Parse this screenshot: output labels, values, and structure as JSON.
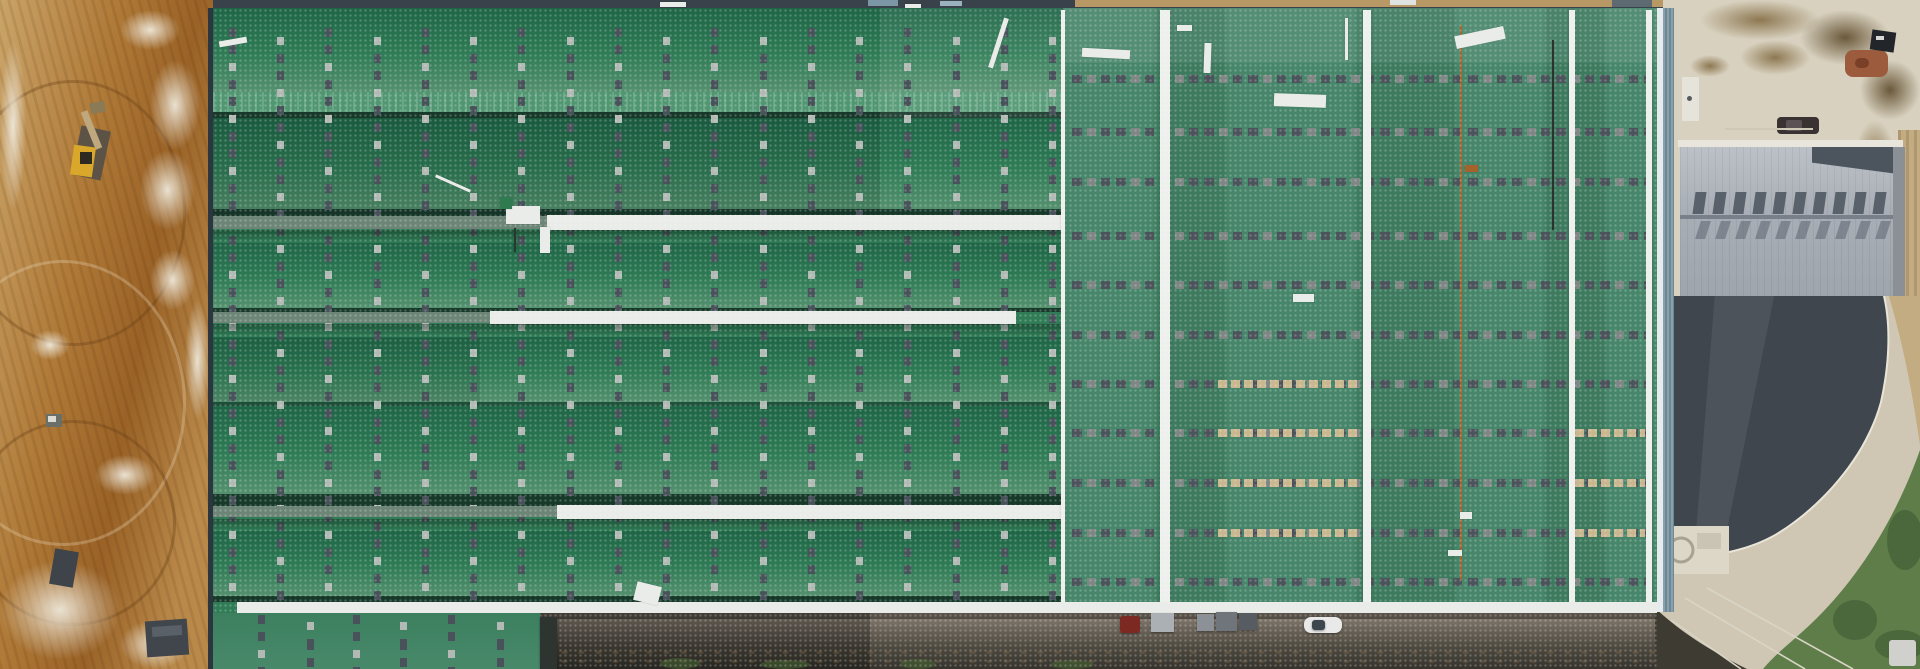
{
  "meta": {
    "scene_type": "aerial-drone-view-industrial-warehouse-roofs-construction-site",
    "width": 1920,
    "height": 669
  },
  "palette": {
    "dirt1": "#caa468",
    "dirt2": "#b07a38",
    "dirt3": "#9a6226",
    "dirt2b": "#b9894a",
    "g-dark": "#1e6546",
    "g-mid": "#2f7c56",
    "g-light": "#55916f",
    "g-ridge": "#4f9671",
    "g-right": "#47866a",
    "g-right-d": "#3d7a5e",
    "seam": "#17392a",
    "walk-white": "#e9ece9",
    "walk-gray": "#6c8576",
    "col-dark": "#49525a",
    "col-light": "#b3bab6",
    "row-dark": "#4b535b",
    "row-mid": "#7e8784",
    "row-beige": "#c9b78f",
    "ridge-white": "#edf0ed",
    "rust": "#a5622a",
    "edge-dark": "#2c363e",
    "edge-blue": "#87a0ad",
    "top-dark": "#39424b",
    "top-tan": "#c7a368",
    "apron": "#d8d1bf",
    "dirttrack": "#c3ab82",
    "groof1": "#bcc1c7",
    "groof2": "#9fa5ad",
    "gvent": "#59616b",
    "gridge": "#798089",
    "gtrap": "#4c545e",
    "parapet": "#e8e5dc",
    "gwall": "#8b9097",
    "slate": "#3f464e",
    "road": "#cfc7b3",
    "roadedge": "#e9e5d8",
    "veg": "#5e7d49",
    "vegd": "#46613a",
    "ground1": "#6e665c",
    "ground2": "#35332c"
  },
  "scene": {
    "green_building": {
      "left_columns_x": [
        229,
        277,
        325,
        374,
        422,
        470,
        518,
        567,
        615,
        663,
        711,
        760,
        808,
        856,
        904,
        953,
        1001,
        1049
      ],
      "extension_columns_x": [
        258,
        307,
        353,
        400,
        448,
        497
      ],
      "right_rows_y": [
        75,
        128,
        178,
        232,
        281,
        331,
        380,
        429,
        479,
        529,
        578
      ],
      "beige_rows": [
        {
          "x": 1218,
          "y": 380,
          "w": 140
        },
        {
          "x": 1218,
          "y": 429,
          "w": 140
        },
        {
          "x": 1218,
          "y": 479,
          "w": 140
        },
        {
          "x": 1218,
          "y": 529,
          "w": 140
        },
        {
          "x": 1575,
          "y": 429,
          "w": 70
        },
        {
          "x": 1575,
          "y": 479,
          "w": 70
        },
        {
          "x": 1575,
          "y": 529,
          "w": 70
        }
      ],
      "ridge_lines": [
        {
          "x": 1061,
          "w": 4
        },
        {
          "x": 1160,
          "w": 10
        },
        {
          "x": 1363,
          "w": 8
        },
        {
          "x": 1569,
          "w": 6
        },
        {
          "x": 1646,
          "w": 6
        }
      ],
      "panel_lines": [
        {
          "x": 1460,
          "y": 25,
          "w": 2,
          "h": 555,
          "color": "#a5622a",
          "name": "rust-seam-line"
        },
        {
          "x": 1552,
          "y": 40,
          "w": 2,
          "h": 190,
          "color": "#2a332e",
          "name": "dark-seam-line"
        }
      ],
      "roof_debris": [
        {
          "x": 219,
          "y": 39,
          "w": 28,
          "h": 6,
          "rot": -10
        },
        {
          "x": 660,
          "y": 2,
          "w": 26,
          "h": 5
        },
        {
          "x": 905,
          "y": 4,
          "w": 16,
          "h": 4
        },
        {
          "x": 996,
          "y": 17,
          "w": 5,
          "h": 52,
          "rot": 18
        },
        {
          "x": 1082,
          "y": 49,
          "w": 48,
          "h": 9,
          "rot": 3
        },
        {
          "x": 1177,
          "y": 25,
          "w": 15,
          "h": 6
        },
        {
          "x": 1204,
          "y": 43,
          "w": 7,
          "h": 30,
          "rot": 2
        },
        {
          "x": 1274,
          "y": 94,
          "w": 52,
          "h": 13,
          "rot": 2
        },
        {
          "x": 1293,
          "y": 294,
          "w": 21,
          "h": 8
        },
        {
          "x": 1455,
          "y": 31,
          "w": 50,
          "h": 13,
          "rot": -12
        },
        {
          "x": 1345,
          "y": 18,
          "w": 3,
          "h": 42
        },
        {
          "x": 635,
          "y": 584,
          "w": 25,
          "h": 19,
          "rot": 14
        },
        {
          "x": 434,
          "y": 182,
          "w": 38,
          "h": 3,
          "rot": 24
        },
        {
          "x": 1465,
          "y": 165,
          "w": 13,
          "h": 7,
          "color": "#a5622a",
          "name": "rust-patch"
        },
        {
          "x": 506,
          "y": 206,
          "w": 34,
          "h": 18,
          "name": "rooftop-equipment"
        },
        {
          "x": 540,
          "y": 227,
          "w": 10,
          "h": 26,
          "name": "rooftop-equipment"
        },
        {
          "x": 514,
          "y": 228,
          "w": 2,
          "h": 24,
          "color": "#2b3633",
          "name": "equipment-cable"
        },
        {
          "x": 500,
          "y": 197,
          "w": 12,
          "h": 12,
          "color": "#2f7a4e",
          "name": "rooftop-equipment"
        },
        {
          "x": 1460,
          "y": 512,
          "w": 12,
          "h": 7
        },
        {
          "x": 1448,
          "y": 550,
          "w": 14,
          "h": 6
        }
      ],
      "top_marks": [
        {
          "x": 868,
          "y": 0,
          "w": 30,
          "h": 6,
          "color": "#7b97a6"
        },
        {
          "x": 940,
          "y": 1,
          "w": 22,
          "h": 5,
          "color": "#9ab2bd"
        },
        {
          "x": 1390,
          "y": 0,
          "w": 26,
          "h": 5,
          "color": "#dfe4e2"
        },
        {
          "x": 1612,
          "y": 0,
          "w": 40,
          "h": 7,
          "color": "#5d6a72"
        }
      ]
    },
    "dirt_area": {
      "rubble_patches": [
        {
          "x": 120,
          "y": 10,
          "w": 60,
          "h": 40
        },
        {
          "x": 150,
          "y": 60,
          "w": 50,
          "h": 90
        },
        {
          "x": 140,
          "y": 150,
          "w": 55,
          "h": 80
        },
        {
          "x": 150,
          "y": 250,
          "w": 45,
          "h": 60
        },
        {
          "x": 0,
          "y": 40,
          "w": 26,
          "h": 170
        },
        {
          "x": 30,
          "y": 330,
          "w": 40,
          "h": 30
        },
        {
          "x": 95,
          "y": 455,
          "w": 60,
          "h": 40
        },
        {
          "x": 0,
          "y": 560,
          "w": 120,
          "h": 100
        },
        {
          "x": 120,
          "y": 620,
          "w": 70,
          "h": 49
        },
        {
          "x": 185,
          "y": 300,
          "w": 25,
          "h": 120
        }
      ],
      "track_arcs": [
        {
          "x": -40,
          "y": 80,
          "w": 220,
          "h": 260
        },
        {
          "x": -60,
          "y": 260,
          "w": 240,
          "h": 280,
          "light": true
        },
        {
          "x": -30,
          "y": 420,
          "w": 200,
          "h": 200
        }
      ],
      "objects": [
        {
          "name": "excavator-tracks",
          "x": 76,
          "y": 128,
          "w": 30,
          "h": 50,
          "rot": 12,
          "color": "#5c5346"
        },
        {
          "name": "excavator-arm",
          "x": 88,
          "y": 110,
          "w": 7,
          "h": 40,
          "rot": -22,
          "color": "#bfa87e"
        },
        {
          "name": "excavator-bucket",
          "x": 90,
          "y": 102,
          "w": 15,
          "h": 11,
          "rot": -10,
          "color": "#8a7a55"
        },
        {
          "name": "excavator-body",
          "x": 72,
          "y": 146,
          "w": 22,
          "h": 30,
          "rot": 8,
          "color": "#d9a82b"
        },
        {
          "name": "excavator-cab",
          "x": 80,
          "y": 152,
          "w": 12,
          "h": 12,
          "color": "#2e2a22"
        },
        {
          "name": "small-machine",
          "x": 46,
          "y": 414,
          "w": 16,
          "h": 13,
          "color": "#6b6f6a"
        },
        {
          "name": "small-machine-top",
          "x": 48,
          "y": 416,
          "w": 8,
          "h": 6,
          "color": "#dcdcd4"
        },
        {
          "name": "container",
          "x": 52,
          "y": 550,
          "w": 24,
          "h": 36,
          "rot": 10,
          "color": "#3f444a"
        },
        {
          "name": "container",
          "x": 146,
          "y": 620,
          "w": 42,
          "h": 36,
          "rot": -4,
          "color": "#41464c"
        },
        {
          "name": "container-lid",
          "x": 152,
          "y": 626,
          "w": 30,
          "h": 10,
          "rot": -4,
          "color": "#596068"
        }
      ]
    },
    "apron": {
      "stains": [
        {
          "x": 1700,
          "y": 0,
          "w": 120,
          "h": 40
        },
        {
          "x": 1800,
          "y": 10,
          "w": 90,
          "h": 55,
          "dark": true
        },
        {
          "x": 1740,
          "y": 40,
          "w": 70,
          "h": 35
        },
        {
          "x": 1860,
          "y": 60,
          "w": 60,
          "h": 60,
          "dark": true
        },
        {
          "x": 1690,
          "y": 55,
          "w": 40,
          "h": 22
        },
        {
          "x": 1855,
          "y": 120,
          "w": 40,
          "h": 80
        }
      ],
      "objects": [
        {
          "name": "parked-car",
          "x": 1777,
          "y": 117,
          "w": 42,
          "h": 17,
          "color": "#3a3133",
          "r": 4
        },
        {
          "name": "parked-car-roof",
          "x": 1786,
          "y": 120,
          "w": 16,
          "h": 11,
          "color": "#5a5254",
          "r": 2
        },
        {
          "name": "debris-pile",
          "x": 1845,
          "y": 50,
          "w": 43,
          "h": 27,
          "color": "#9c5b3c",
          "r": 8
        },
        {
          "name": "debris-pile-spot",
          "x": 1855,
          "y": 58,
          "w": 14,
          "h": 10,
          "color": "#7a4027",
          "r": 5
        },
        {
          "name": "dark-object",
          "x": 1871,
          "y": 31,
          "w": 24,
          "h": 20,
          "rot": 8,
          "color": "#22252a"
        },
        {
          "name": "dark-object-mark",
          "x": 1876,
          "y": 36,
          "w": 8,
          "h": 4,
          "color": "#d8d8d8"
        },
        {
          "name": "rooftop-unit",
          "x": 1682,
          "y": 77,
          "w": 17,
          "h": 44,
          "color": "#e6e3da"
        },
        {
          "name": "rooftop-unit-dot",
          "x": 1687,
          "y": 96,
          "w": 5,
          "h": 5,
          "color": "#555b60",
          "r": 3
        },
        {
          "name": "parking-line",
          "x": 1725,
          "y": 128,
          "w": 88,
          "h": 2,
          "color": "#cfc8b6"
        }
      ]
    },
    "gray_building": {
      "vent_count": 10,
      "vent_start_x": 1694,
      "vent_step": 20,
      "vent_y_upper": 192,
      "vent_y_lower": 221
    },
    "vehicles": [
      {
        "name": "red-car",
        "x": 1120,
        "y": 616,
        "w": 20,
        "h": 17,
        "color": "#7c2a21",
        "r": 3
      },
      {
        "name": "stacked-materials",
        "x": 1151,
        "y": 613,
        "w": 23,
        "h": 19,
        "color": "#aab0b4",
        "stack": true
      },
      {
        "name": "stacked-materials",
        "x": 1197,
        "y": 614,
        "w": 17,
        "h": 17,
        "color": "#8b9196",
        "stack": true
      },
      {
        "name": "stacked-materials",
        "x": 1216,
        "y": 612,
        "w": 21,
        "h": 19,
        "color": "#6f757a",
        "stack": true
      },
      {
        "name": "stacked-materials",
        "x": 1239,
        "y": 613,
        "w": 18,
        "h": 17,
        "color": "#565c61",
        "stack": true
      },
      {
        "name": "white-car",
        "x": 1304,
        "y": 617,
        "w": 38,
        "h": 16,
        "color": "#e8e9e8",
        "r": 7
      },
      {
        "name": "white-car-window",
        "x": 1312,
        "y": 620,
        "w": 13,
        "h": 10,
        "color": "#3d454d",
        "r": 3
      },
      {
        "name": "dark-structure",
        "x": 540,
        "y": 617,
        "w": 17,
        "h": 52,
        "color": "#2e3531"
      }
    ],
    "vegetation_tufts": [
      {
        "x": 660,
        "y": 658,
        "w": 40,
        "h": 11
      },
      {
        "x": 760,
        "y": 660,
        "w": 50,
        "h": 9
      },
      {
        "x": 900,
        "y": 659,
        "w": 36,
        "h": 10
      },
      {
        "x": 1050,
        "y": 660,
        "w": 44,
        "h": 9
      }
    ]
  }
}
